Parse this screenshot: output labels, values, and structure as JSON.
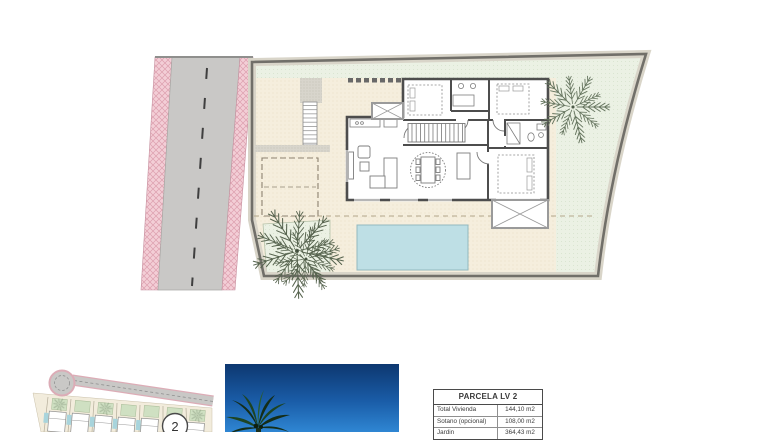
{
  "document": {
    "type": "architectural-site-plan",
    "views": [
      "villa-floor-plan-with-plot",
      "development-site-map",
      "palm-sky-photo",
      "area-table"
    ]
  },
  "table": {
    "title": "PARCELA LV 2",
    "rows": [
      {
        "label": "Total Vivienda",
        "value": "144,10 m2"
      },
      {
        "label": "Sotano (opcional)",
        "value": "108,00 m2"
      },
      {
        "label": "Jardin",
        "value": "364,43 m2"
      }
    ]
  },
  "site_map": {
    "marker_label": "2"
  },
  "palette": {
    "garden_cream": "#f5eedd",
    "lawn_green": "#ebf1e4",
    "pool_blue": "#bedfe5",
    "road_grey": "#c9c8c6",
    "road_hatch_pink": "#f3ced6",
    "wall_grey": "#4d4d4d",
    "boundary_grey": "#716f69",
    "photo_sky_top": "#0d3770",
    "photo_sky_bottom": "#2f86d3"
  }
}
